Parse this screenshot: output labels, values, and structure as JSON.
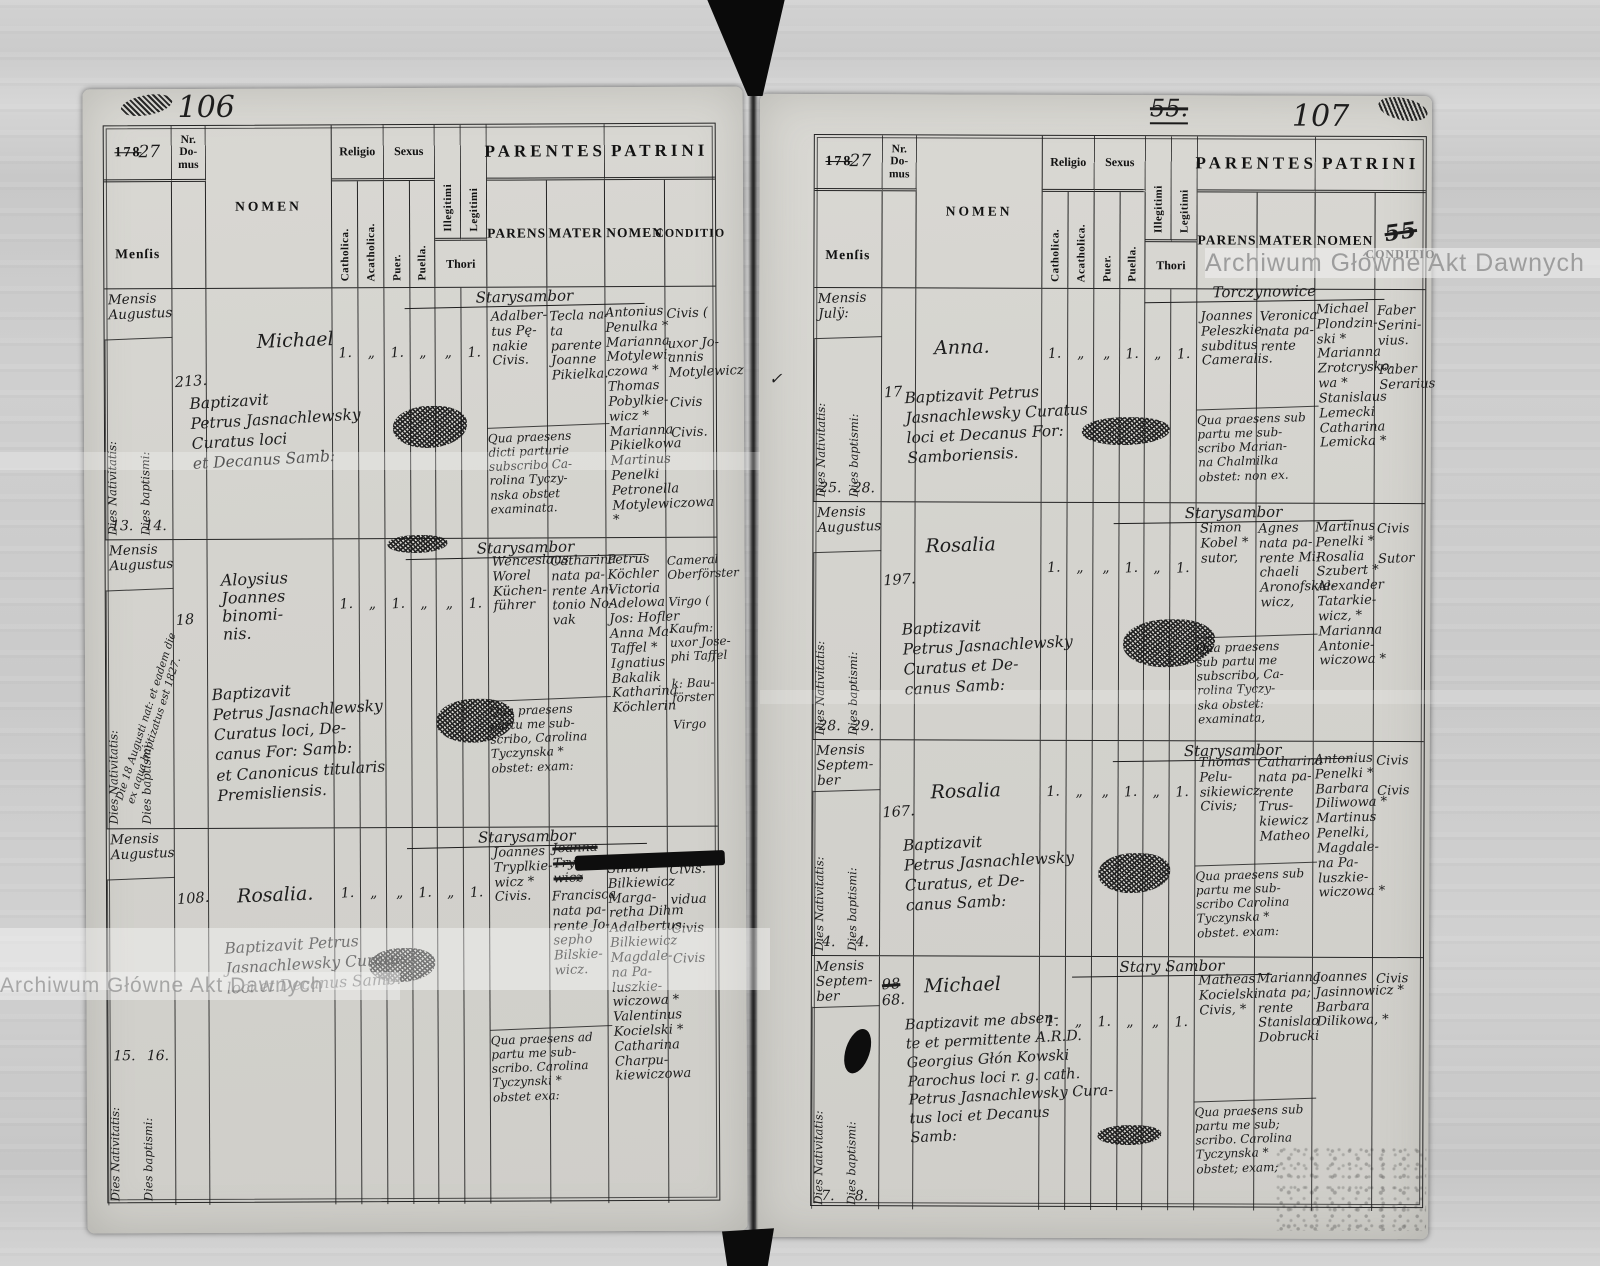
{
  "scan": {
    "watermark": "Archiwum Główne Akt Dawnych"
  },
  "year": {
    "print": "178",
    "hand": "27"
  },
  "cols": {
    "nr": "Nr.\nDo-\nmus",
    "mensis": "Menſis",
    "nomen": "NOMEN",
    "religio": "Religio",
    "catholica": "Catholica.",
    "acatholica": "Acatholica.",
    "sexus": "Sexus",
    "puer": "Puer.",
    "puella": "Puella.",
    "illegitimi": "Illegitimi",
    "legitimi": "Legitimi",
    "thori": "Thori",
    "parentes": "PARENTES",
    "parens": "PARENS",
    "mater": "MATER",
    "patrini": "PATRINI",
    "pnomen": "NOMEN",
    "conditio": "CONDITIO"
  },
  "left": {
    "number": "106",
    "records": [
      {
        "month": "Mensis\nAugustus",
        "nat_label": "Dies Nativitatis:",
        "bapt_label": "Dies baptismi:",
        "nat": "13.",
        "bapt": "14.",
        "house": "213.",
        "name": "Michael",
        "marks": [
          "1.",
          "„",
          "1.",
          "„",
          "„",
          "1."
        ],
        "bapt_text": "Baptizavit\nPetrus Jasnachlewsky\nCuratus loci\net Decanus Samb:",
        "village": "Starysambor",
        "parens": "Adalber-\ntus Pę-\nnakie\nCivis.",
        "midwife": "Qua praesens\ndicti parturie\nsubscribo Ca-\nrolina Tyczy-\nnska obstet\nexaminata.",
        "mater": "Tecla na-\nta parente\nJoanne\nPikielka.",
        "patrini": "Antonius\nPenulka *\nMarianna\nMotylewi-\nczowa *\nThomas\nPobylkie-\nwicz *\nMarianna\nPikielkowa\nMartinus\nPenelki\nPetronella\nMotylewiczowa *",
        "conditio": "Civis (\n\nuxor Jo-\nannis\nMotylewicz\n\nCivis\n\nCivis."
      },
      {
        "month": "Mensis\nAugustus",
        "nat_label": "Dies Nativitatis:",
        "bapt_label": "Dies baptismi:",
        "nat": "",
        "bapt": "",
        "note": "Die 18 Augusti nat: et eadem die\nex aqua baptizatus est 1827.",
        "house": "18",
        "name": "Aloysius\nJoannes\nbinomi-\nnis.",
        "marks": [
          "1.",
          "„",
          "1.",
          "„",
          "„",
          "1."
        ],
        "bapt_text": "Baptizavit\nPetrus Jasnachlewsky\nCuratus loci, De-\ncanus For: Samb:\net Canonicus titularis\nPremisliensis.",
        "village": "Starysambor",
        "parens": "Wenceslaus\nWorel\nKüchen-\nführer",
        "midwife": "Qua praesens\npartu me sub-\nscribo, Carolina\nTyczynska *\nobstet: exam:",
        "mater": "Catharina\nnata pa-\nrente An-\ntonio No-\nvak",
        "patrini": "Petrus\nKöchler\nVictoria\nAdelowa\nJos: Hofler\nAnna Ma-\nTaffel *\nIgnatius\nBakalik\nKatharina\nKöchlerin",
        "conditio": "Cameral\nOberförster\n\nVirgo (\n\nKaufm:\nuxor Jose-\nphi Taffel\n\nk: Bau-\nförster\n\nVirgo"
      },
      {
        "month": "Mensis\nAugustus",
        "nat_label": "Dies Nativitatis:",
        "bapt_label": "Dies baptismi:",
        "nat": "15.",
        "bapt": "16.",
        "house": "108.",
        "name": "Rosalia.",
        "marks": [
          "1.",
          "„",
          "„",
          "1.",
          "„",
          "1."
        ],
        "bapt_text": "Baptizavit Petrus\nJasnachlewsky Curatus\nloci et Decanus Samb:",
        "village": "Starysambor",
        "parens": "Joannes\nTryplkie-\nwicz *\nCivis.",
        "midwife": "Qua praesens ad\npartu me sub-\nscribo. Carolina\nTyczynski *\nobstet exa:",
        "mater_struck": "Joanna\nTryplkie-\nwicz",
        "mater": "Francisca\nnata pa-\nrente Jo-\nsepho\nBilskie-\nwicz.",
        "patrini": "Simon\nBilkiewicz\nMarga-\nretha Dihm\nAdalbertus\nBilkiewicz\nMagdale-\nna Pa-\nluszkie-\nwiczowa *\nValentinus\nKocielski *\nCatharina\nCharpu-\nkiewiczowa",
        "conditio": "Civis.\n\nvidua\n\nCivis\n\nCivis"
      }
    ]
  },
  "right": {
    "number": "107",
    "struck_top": "55.",
    "struck_conditio": "55",
    "check": "✓",
    "records": [
      {
        "month": "Mensis\nJulÿ:",
        "nat_label": "Dies Nativitatis:",
        "bapt_label": "Dies baptismi:",
        "nat": "25.",
        "bapt": "28.",
        "house": "17",
        "name": "Anna.",
        "marks": [
          "1.",
          "„",
          "„",
          "1.",
          "„",
          "1."
        ],
        "bapt_text": "Baptizavit Petrus\nJasnachlewsky Curatus\nloci et Decanus For:\nSamboriensis.",
        "village": "Torczynowice",
        "parens": "Joannes\nPeleszkie\nsubditus\nCameralis.",
        "midwife": "Qua praesens sub\npartu me sub-\nscribo Marian-\nna Chalmilka\nobstet: non ex.",
        "mater": "Veronica\nnata pa-\nrente",
        "patrini": "Michael\nPlondzin-\nski *\nMarianna\nZrotcrysko-\nwa *\nStanislaus\nLemecki\nCatharina\nLemicka *",
        "conditio": "Faber\nSerini-\nvius.\n\nFaber\nSerarius"
      },
      {
        "month": "Mensis\nAugustus",
        "nat_label": "Dies Nativitatis:",
        "bapt_label": "Dies baptismi:",
        "nat": "28.",
        "bapt": "29.",
        "house": "197.",
        "name": "Rosalia",
        "marks": [
          "1.",
          "„",
          "„",
          "1.",
          "„",
          "1."
        ],
        "bapt_text": "Baptizavit\nPetrus Jasnachlewsky\nCuratus et De-\ncanus Samb:",
        "village": "Starysambor",
        "parens": "Simon\nKobel *\nsutor,",
        "midwife": "Qua praesens\nsub partu me\nsubscribo, Ca-\nrolina Tyczy-\nska obstet:\nexaminata,",
        "mater": "Agnes\nnata pa-\nrente Mi-\nchaeli\nAronofskie-\nwicz,",
        "patrini": "Martinus\nPenelki *\nRosalia\nSzubert *\nAlexander\nTatarkie-\nwicz, *\nMarianna\nAntonie-\nwiczowa *",
        "conditio": "Civis\n\nSutor"
      },
      {
        "month": "Mensis\nSeptem-\nber",
        "nat_label": "Dies Nativitatis:",
        "bapt_label": "Dies baptismi:",
        "nat": "4.",
        "bapt": "4.",
        "house": "167.",
        "name": "Rosalia",
        "marks": [
          "1.",
          "„",
          "„",
          "1.",
          "„",
          "1."
        ],
        "bapt_text": "Baptizavit\nPetrus Jasnachlewsky\nCuratus, et De-\ncanus Samb:",
        "village": "Starysambor",
        "parens": "Thomas\nPelu-\nsikiewicz\nCivis;",
        "midwife": "Qua praesens sub\npartu me sub-\nscribo Carolina\nTyczynska *\nobstet. exam:",
        "mater": "Catharina\nnata pa-\nrente Trus-\nkiewicz\nMatheo",
        "patrini": "Antonius\nPenelki *\nBarbara\nDiliwowa *\nMartinus\nPenelki,\nMagdale-\nna Pa-\nluszkie-\nwiczowa *",
        "conditio": "Civis\n\nCivis"
      },
      {
        "month": "Mensis\nSeptem-\nber",
        "nat_label": "Dies Nativitatis:",
        "bapt_label": "Dies baptismi:",
        "nat": "7.",
        "bapt": "8.",
        "house_struck": "98",
        "house": "68.",
        "name": "Michael",
        "marks": [
          "1.",
          "„",
          "1.",
          "„",
          "„",
          "1."
        ],
        "bapt_text": "Baptizavit me absen-\nte et permittente A.R.D.\nGeorgius Głón Kowski\nParochus loci r. g. cath.\nPetrus Jasnachlewsky Cura-\ntus loci et Decanus\nSamb:",
        "village": "Stary Sambor",
        "parens": "Matheas\nKocielski\nCivis, *",
        "midwife": "Qua praesens sub\npartu me sub;\nscribo. Carolina\nTyczynska *\nobstet; exam;",
        "mater": "Marianna\nnata pa;\nrente\nStanislao\nDobrucki",
        "patrini": "Joannes\nJasinnowicz *\nBarbara\nDilikowa, *",
        "conditio": "Civis"
      }
    ]
  }
}
